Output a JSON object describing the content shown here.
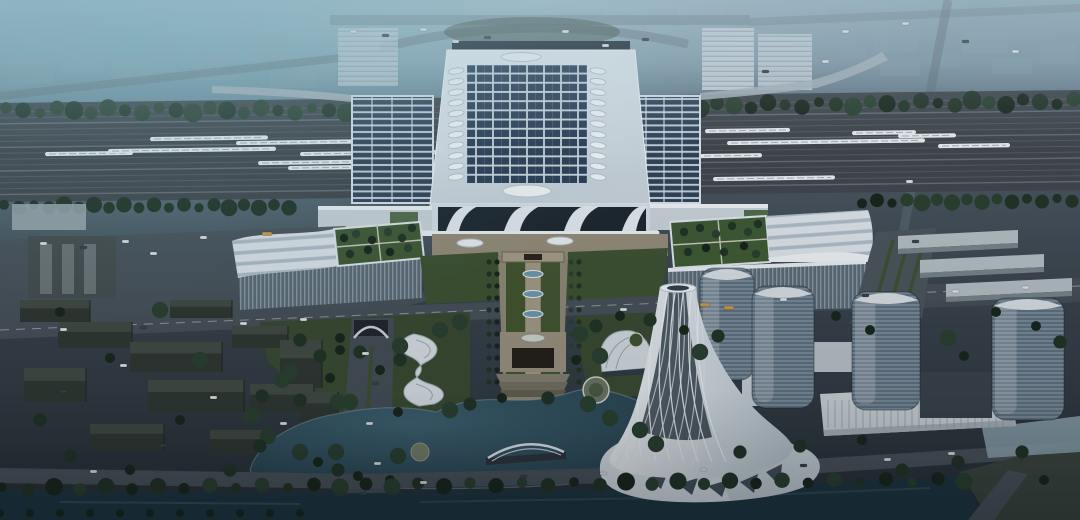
{
  "scene": {
    "title": "Aerial dusk architectural rendering of a high-speed railway station complex with solar-panel roof, platform canopies with trains, green-roof wing buildings, landscaped central axis leading to a lake with an arch bridge, a twisted white landmark tower, glass office towers and surrounding city blocks",
    "elements": [
      "background-city",
      "railway-yard",
      "high-speed-trains",
      "station-main-hall",
      "solar-panel-roof",
      "skylight-row",
      "platform-canopy-left",
      "platform-canopy-right",
      "station-entrance-arches",
      "left-wing-building",
      "right-wing-building",
      "green-roof-garden",
      "central-landscaped-axis",
      "gate-pavilion",
      "esplanade-ovals",
      "lake",
      "arch-bridge",
      "canal",
      "twisted-landmark-tower",
      "fan-pavilion",
      "s-curve-pavilion",
      "glass-tower",
      "podium-building",
      "warehouse-row",
      "city-blocks",
      "boulevard-tunnel",
      "roads",
      "vehicles",
      "trees"
    ]
  },
  "palette": {
    "haze_top": "#8ea8b6",
    "haze_teal": "#7fb0bf",
    "city_bg": "#90a4b1",
    "ground_mid": "#39424b",
    "ground_dark": "#272f37",
    "rail_bed": "#40464c",
    "rail_line": "#575f66",
    "rail_line_light": "#6a747d",
    "train_white": "#e9eef2",
    "roof_white": "#e3eaf0",
    "roof_shade": "#b6c3cd",
    "solar_panel": "#2b3e55",
    "solar_gap": "#ccd7e0",
    "glass_dark": "#1e2831",
    "glass_tower": "#5e7181",
    "green_roof": "#3f5a35",
    "tree_dark": "#18261c",
    "tree_mid": "#213326",
    "lawn": "#3e5233",
    "plaza_tan": "#948c7a",
    "plaza_light": "#b3ac99",
    "road": "#474f58",
    "road_dark": "#3a424b",
    "lake": "#32535f",
    "lake_deep": "#24404d",
    "canal": "#1d3641",
    "tower_white": "#dfe6ec",
    "bus_orange": "#c99a4e"
  }
}
